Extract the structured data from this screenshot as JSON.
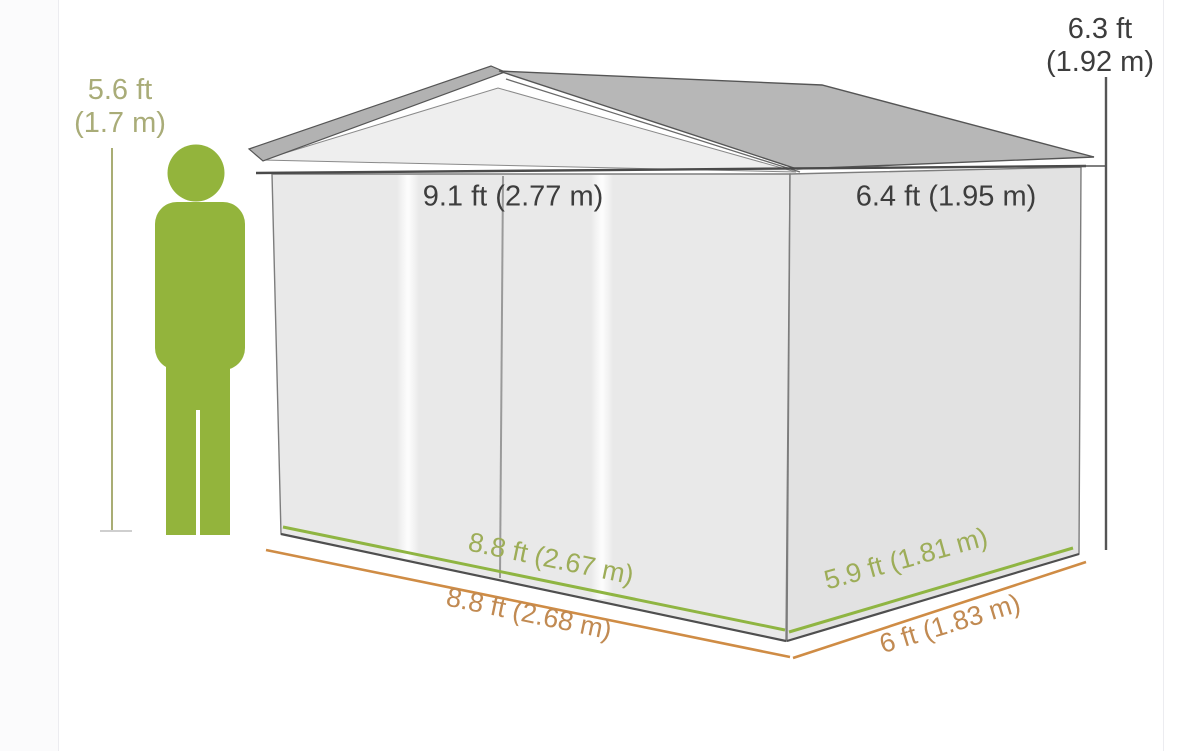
{
  "diagram": {
    "person_height": {
      "ft": "5.6 ft",
      "m": "(1.7 m)"
    },
    "shed_height": {
      "ft": "6.3 ft",
      "m": "(1.92 m)"
    },
    "roof_width": "9.1 ft (2.77 m)",
    "roof_depth": "6.4 ft (1.95 m)",
    "base_width_inner": "8.8 ft (2.67 m)",
    "base_width_outer": "8.8 ft (2.68 m)",
    "base_depth_inner": "5.9 ft (1.81 m)",
    "base_depth_outer": "6 ft (1.83 m)",
    "colors": {
      "person": "#93b43c",
      "person_label": "#a9ac78",
      "person_line": "#a9ad74",
      "inner_dim_text": "#9dad58",
      "outer_dim_text": "#c18a52",
      "dark_text": "#3d3d3d",
      "green_line": "#8fb542",
      "orange_line": "#cf8c45",
      "roof_top": "#b7b7b7",
      "roof_trim": "#b2b2b2",
      "gable_face": "#eeeeee",
      "wall_front": "#e9e9e9",
      "wall_side": "#e2e2e2",
      "outline": "#4a4a4a"
    }
  }
}
